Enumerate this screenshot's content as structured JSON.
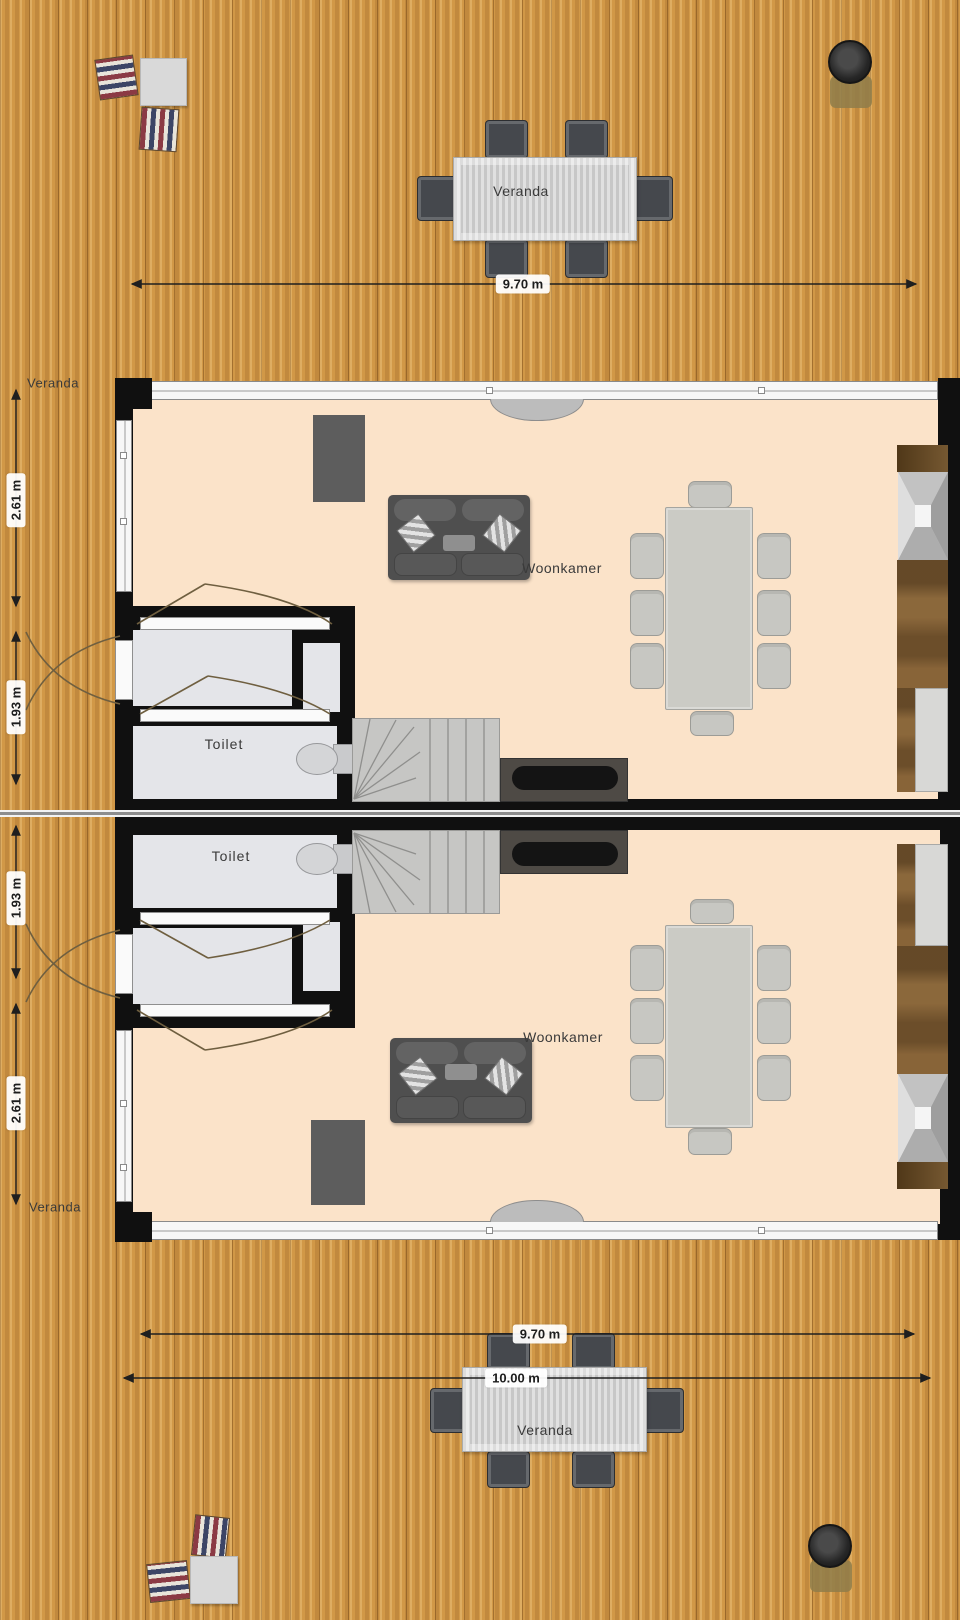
{
  "colors": {
    "deck_wood": "#d19847",
    "living_floor": "#fbe3c9",
    "wall": "#101010",
    "service_floor": "#e4e5e9",
    "counter_wood": "#7b5930"
  },
  "top_veranda": {
    "table_label": "Veranda",
    "width_dim": "9.70 m"
  },
  "unit_top": {
    "side_label": "Veranda",
    "living_depth_dim": "2.61 m",
    "hall_depth_dim": "1.93 m",
    "living_label": "Woonkamer",
    "toilet_label": "Toilet"
  },
  "unit_bottom": {
    "side_label": "Veranda",
    "living_depth_dim": "2.61 m",
    "hall_depth_dim": "1.93 m",
    "living_label": "Woonkamer",
    "toilet_label": "Toilet"
  },
  "bottom_veranda": {
    "table_label": "Veranda",
    "width_dim": "9.70 m",
    "total_width_dim": "10.00 m"
  }
}
